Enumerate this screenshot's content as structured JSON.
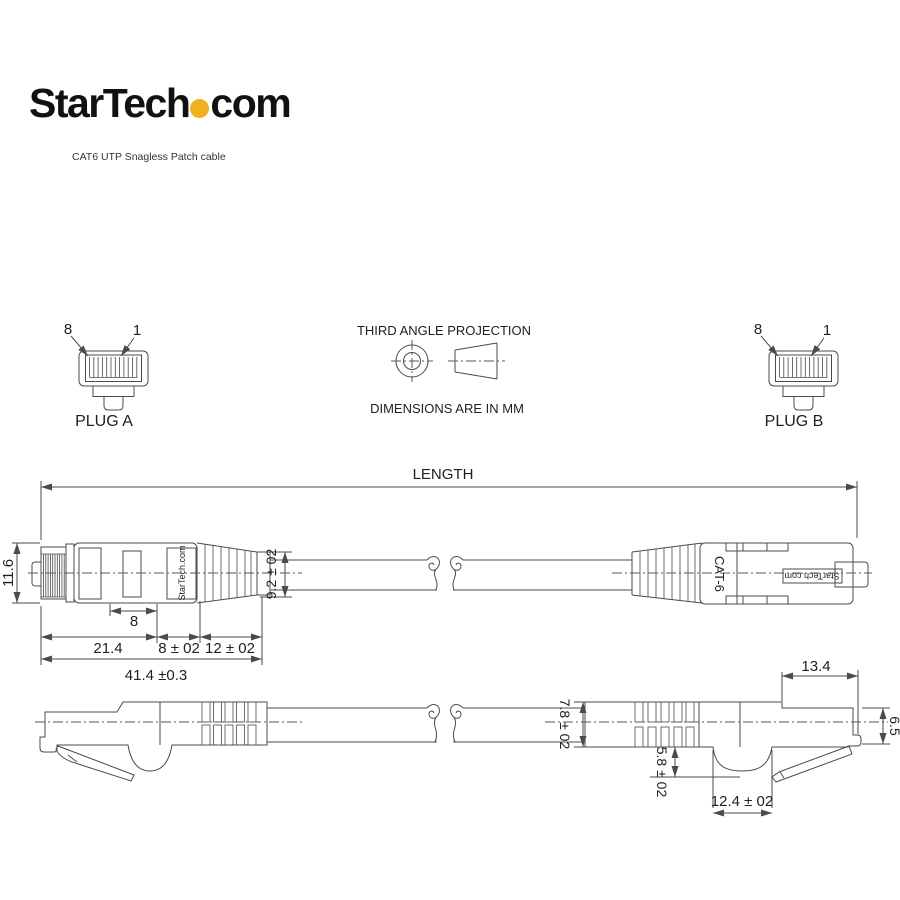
{
  "header": {
    "logo_part1": "StarTech",
    "logo_part2": "com",
    "subtitle": "CAT6 UTP Snagless Patch cable"
  },
  "projection": {
    "title": "THIRD ANGLE PROJECTION",
    "units": "DIMENSIONS ARE IN MM"
  },
  "plug_a": {
    "label": "PLUG A",
    "pin_left": "8",
    "pin_right": "1"
  },
  "plug_b": {
    "label": "PLUG B",
    "pin_left": "8",
    "pin_right": "1"
  },
  "dimensions": {
    "length": "LENGTH",
    "plug_height": "11.6",
    "boot_end_height": "9.2 ± 02",
    "slot": "8",
    "body_length": "21.4",
    "relief_length": "8 ± 02",
    "boot_length": "12 ± 02",
    "overall": "41.4 ±0.3",
    "nose_length": "13.4",
    "nose_height": "6.5",
    "cable_height": "7.8 ± 02",
    "latch_depth": "5.8 ± 02",
    "cavity_width": "12.4 ± 02"
  },
  "labels": {
    "brand_left": "StarTech.com",
    "cat": "CAT-6",
    "brand_right": "StarTech.com"
  },
  "colors": {
    "accent": "#F2B01E",
    "line": "#4b4b4b",
    "text": "#1f1f1f"
  }
}
